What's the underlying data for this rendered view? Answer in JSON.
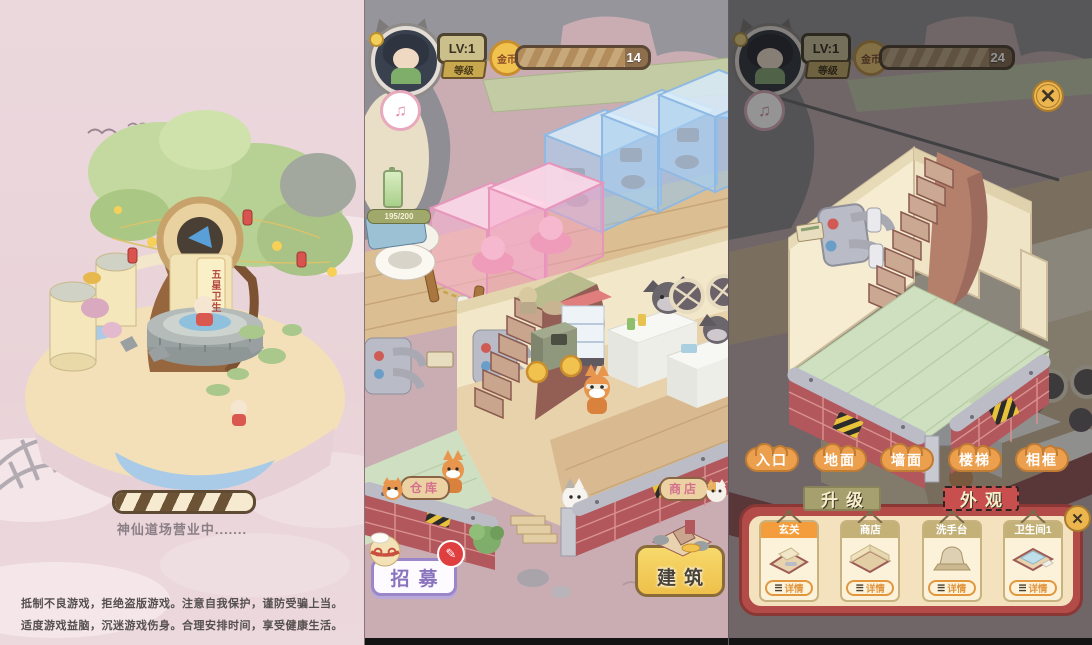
{
  "panel1": {
    "tower_sign": "五星卫生",
    "loading_caption": "神仙道场营业中.......",
    "disclaimer_line1": "抵制不良游戏，拒绝盗版游戏。注意自我保护，谨防受骗上当。",
    "disclaimer_line2": "适度游戏益脑，沉迷游戏伤身。合理安排时间，享受健康生活。"
  },
  "hud": {
    "level_value": "LV:1",
    "level_label": "等级",
    "coin_label": "金币",
    "battery_value": "195/200",
    "music_icon": "♫",
    "close_icon": "✕",
    "edit_badge_icon": "✎"
  },
  "panel2": {
    "coin_value": "14",
    "warehouse_label": "仓库",
    "shop_label": "商店",
    "recruit_label": "招募",
    "build_label": "建筑"
  },
  "panel3": {
    "coin_value": "24",
    "tabs": [
      "入口",
      "地面",
      "墙面",
      "楼梯",
      "相框"
    ],
    "upgrade_tab": "升级",
    "appearance_tab": "外观",
    "detail_icon": "☰",
    "cards": [
      {
        "name": "玄关",
        "detail": "详情"
      },
      {
        "name": "商店",
        "detail": "详情"
      },
      {
        "name": "洗手台",
        "detail": "详情"
      },
      {
        "name": "卫生间1",
        "detail": "详情"
      }
    ]
  },
  "colors": {
    "accent_orange": "#ec9f4d",
    "panel_red": "#b34b48",
    "selected_card": "#f49d3c",
    "coin_yellow": "#f2c24e",
    "loading_bg": "#e9d3d8",
    "game_bg": "#c9adb3"
  }
}
